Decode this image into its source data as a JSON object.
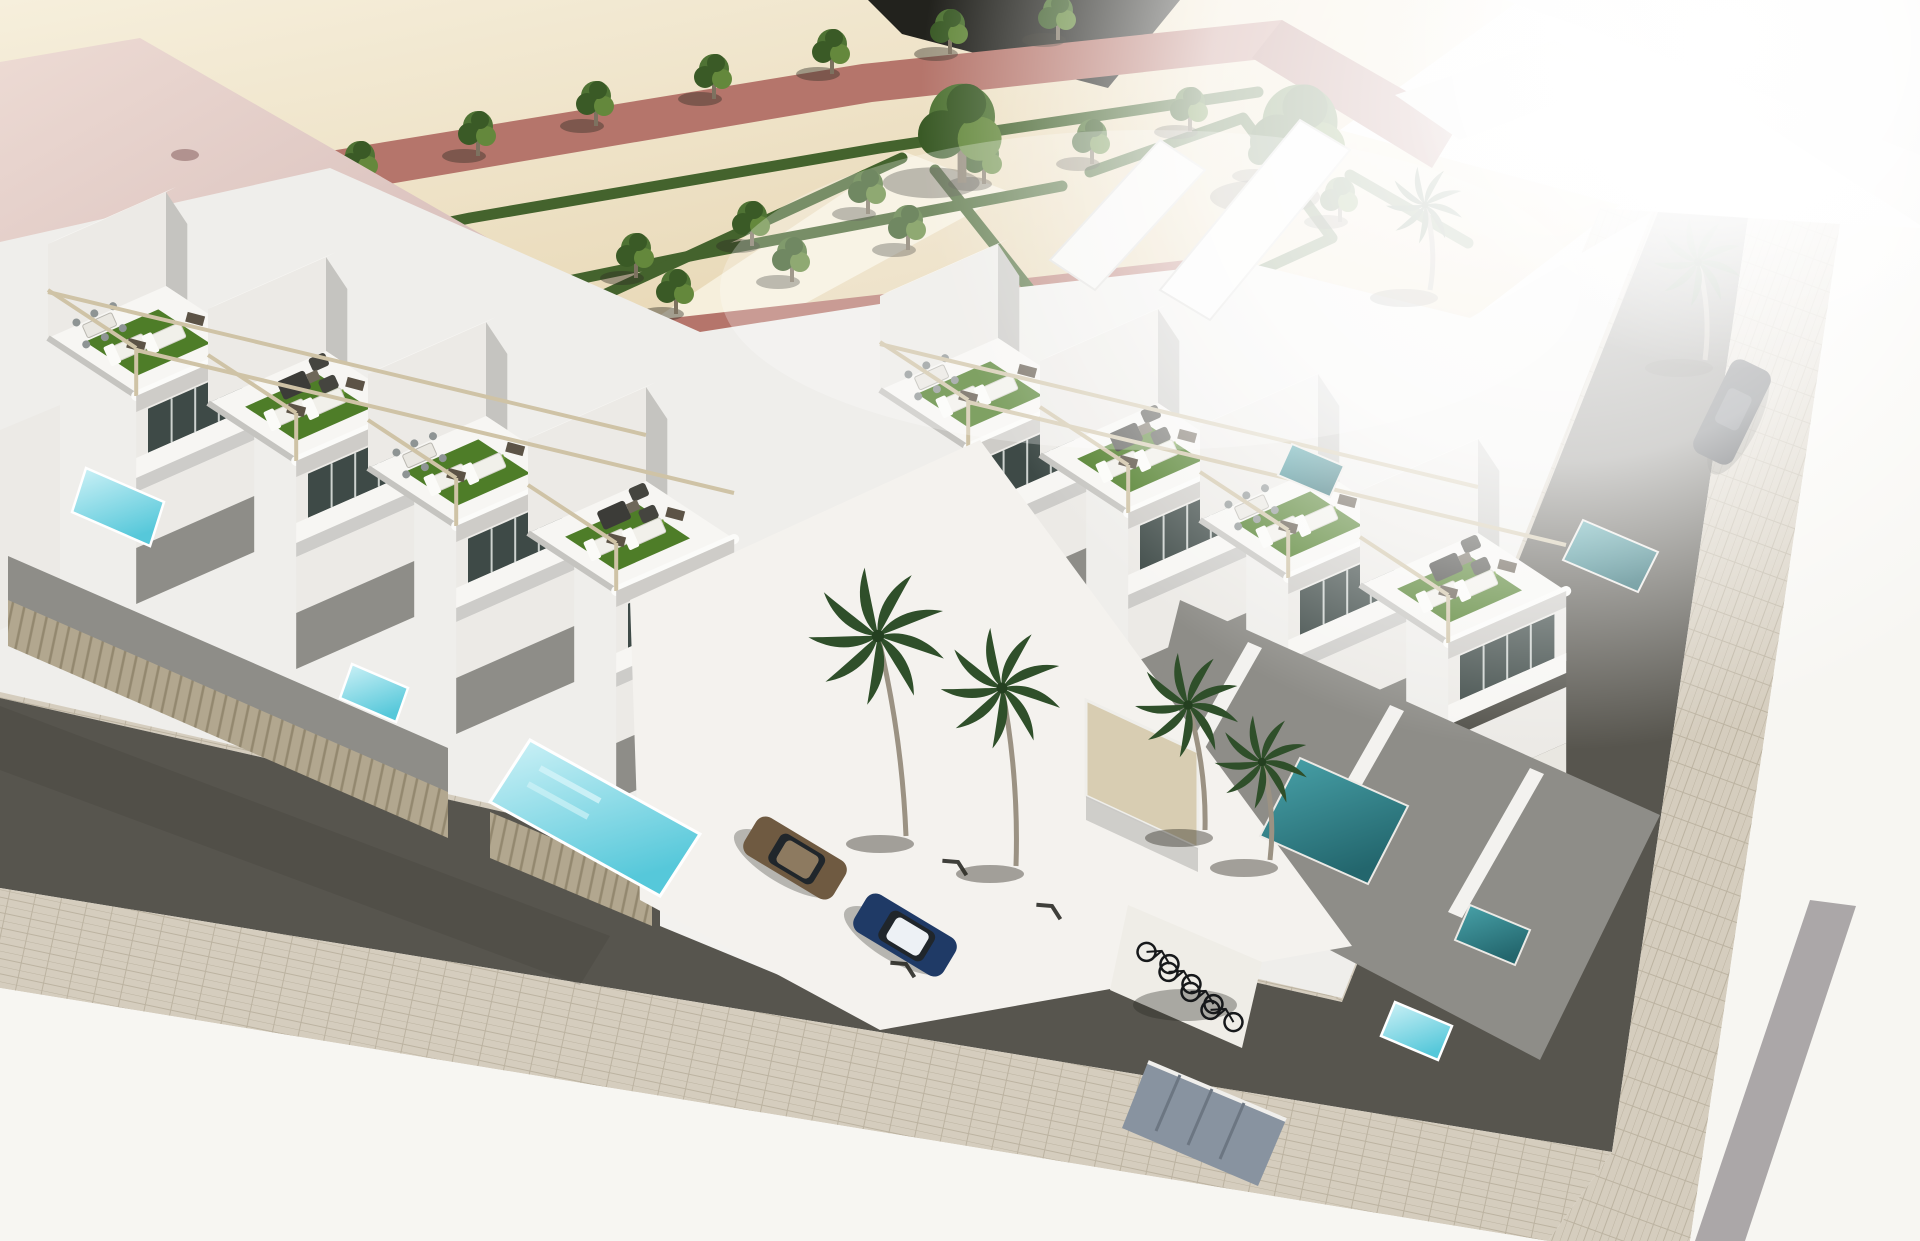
{
  "meta": {
    "title": "Aerial 3D render - modern white townhouse complex",
    "description": "Bird's-eye 3D architectural rendering of a corner block of modern white townhouses with roof terraces, artificial-turf sun decks, pergolas, private plunge pools, a landscaped sand park with hedge parterres, rows of small trees and red walkways, palm trees, parked cars, a bicycle shelter and surrounding dark asphalt streets with paved sidewalks. A large pale-pink flat roof building sits at the top left; the top right is washed out by bright sunlight. No text is visible in the image.",
    "width_px": 1920,
    "height_px": 1241,
    "visible_text": "none"
  },
  "colors": {
    "sand": "#e7d5b1",
    "sand_light": "#f6efdc",
    "path_red": "#b5756b",
    "path_red_deep": "#a2625a",
    "dark_wedge": "#22221d",
    "hedge": "#44632d",
    "tree": "#4f7334",
    "tree_dark": "#3a5a26",
    "tree_light": "#64883c",
    "shadow": "rgba(48,46,36,0.42)",
    "turf": "#4e7d28",
    "turf_light": "#6a9733",
    "white_top": "#f7f6f3",
    "white_wall": "#eceae6",
    "gray_wall": "#c5c4c0",
    "gray_deck": "#8e8d88",
    "glass": "#3e4a47",
    "fence": "#b2a78f",
    "fence_dark": "#93886f",
    "pergola": "#cfc3a6",
    "pergola_cap": "#5c5346",
    "pool_bright": "#62cfdf",
    "pool_light": "#cff2f7",
    "pool_deep": "#2f8289",
    "asphalt": "#57554e",
    "paver": "#d5cdbe",
    "paver_line": "#bcb3a1",
    "white_ground": "#f7f6f2",
    "gray_stripe": "#9e999b",
    "roof_pink": "#dcc2be",
    "roof_pink_light": "#ecdad3",
    "palm": "#2f4f2a",
    "trunk": "#9b9283",
    "car_bronze": "#6f5a41",
    "car_blue": "#1f3a66",
    "car_roof": "#edf1f5",
    "car_dark": "#22262b",
    "box_gray": "#8893a0",
    "door_beige": "#d8cdb2"
  },
  "scene": {
    "park": {
      "ground": "sand gravel",
      "small_trees": 23,
      "large_trees": 3,
      "hedge_parterres": 4,
      "red_walkways": 2,
      "white_paths": 2
    },
    "buildings": {
      "residential_rows": 2,
      "visible_townhouse_units": 8,
      "roof_terraces_with_turf": 8,
      "pergolas": true,
      "pink_roof_building": 1
    },
    "pools": {
      "bright_plunge_pools": 3,
      "lap_pool": 1,
      "shaded_pools": 4
    },
    "vehicles": {
      "bronze_car": 1,
      "blue_car_white_roof": 1,
      "dark_car": 1,
      "bicycles": 4
    },
    "vegetation": {
      "palm_trees": 6
    },
    "streets": {
      "asphalt_roads": 2,
      "paver_sidewalks": true,
      "bright_overexposed_corners": 2
    }
  }
}
